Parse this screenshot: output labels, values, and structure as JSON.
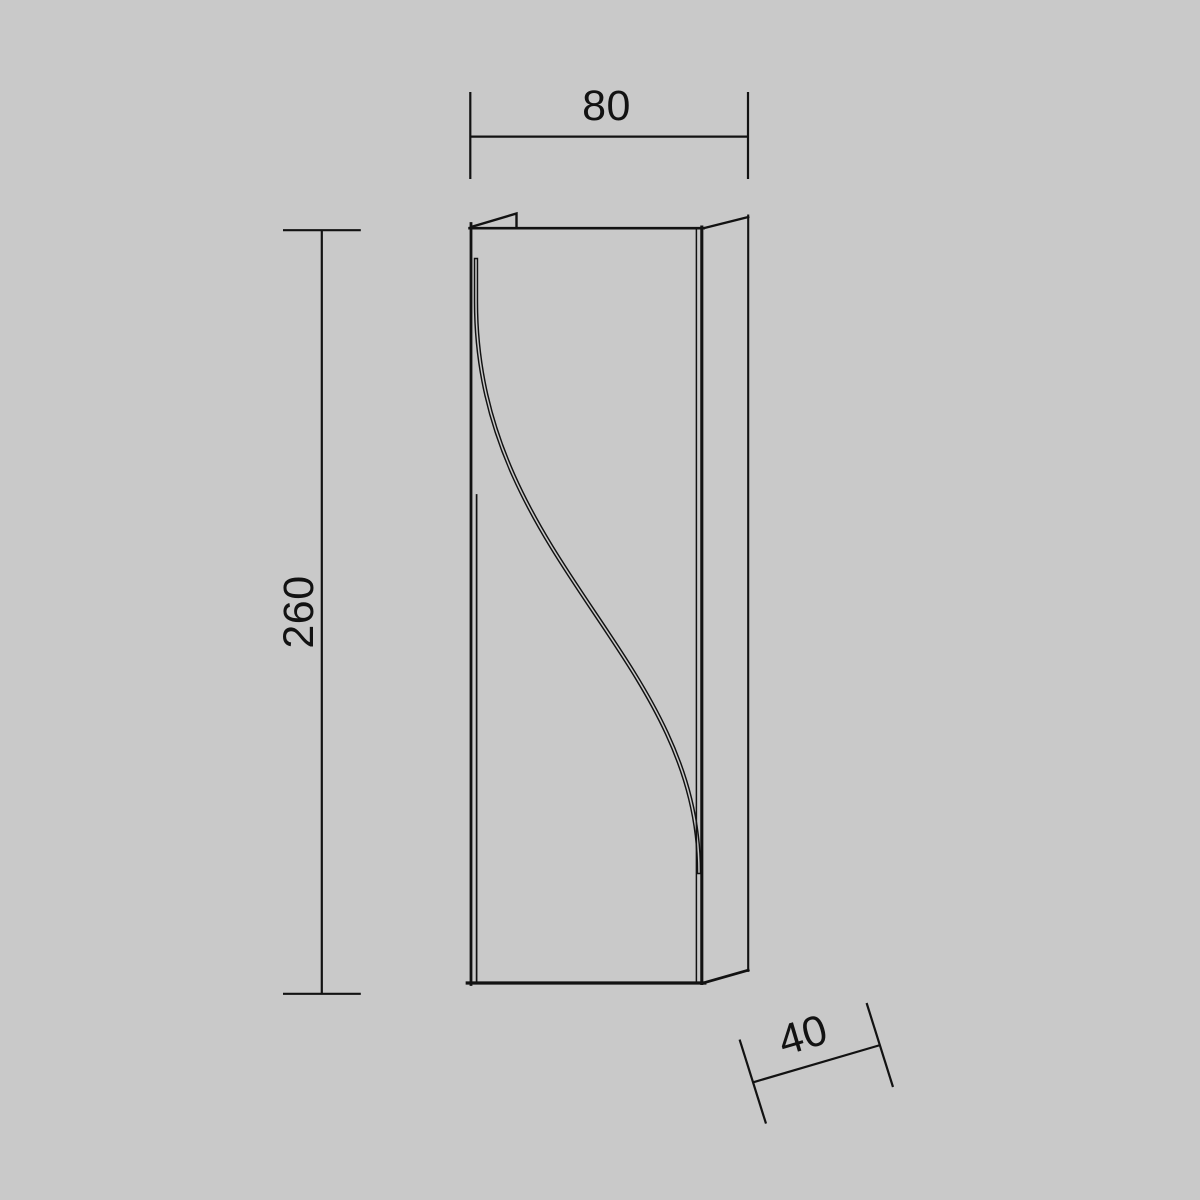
{
  "colors": {
    "background": "#c9c9c9",
    "line": "#121212"
  },
  "dimensions": {
    "width": "80",
    "height": "260",
    "depth": "40"
  }
}
